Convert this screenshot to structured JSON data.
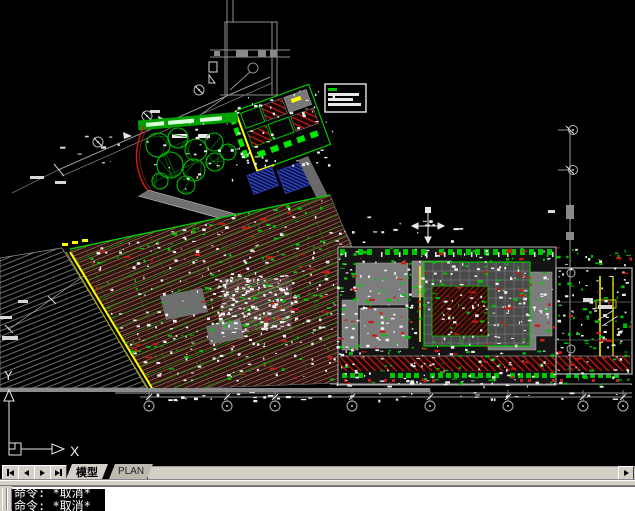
{
  "colors": {
    "canvas_bg": "#000000",
    "chrome_bg": "#d4d0c8",
    "cad_gray": "#8c8c8c",
    "light_gray": "#b4b4b4",
    "white": "#f0f0f0",
    "green": "#00c800",
    "bright_green": "#00e600",
    "dark_green": "#007800",
    "red": "#c81e14",
    "dark_red": "#8f1e14",
    "brown_hatch": "#9a5448",
    "yellow": "#ffff00",
    "blue_hatch_line": "#3c55d2",
    "blue_hatch_bg": "#0a1250"
  },
  "tabs": {
    "nav": [
      {
        "name": "first-tab-button"
      },
      {
        "name": "prev-tab-button"
      },
      {
        "name": "next-tab-button"
      },
      {
        "name": "last-tab-button"
      }
    ],
    "items": [
      {
        "label": "模型",
        "active": true
      },
      {
        "label": "PLAN",
        "active": false
      }
    ]
  },
  "command": {
    "lines": [
      "命令: *取消*",
      "命令: *取消*"
    ]
  },
  "ucs": {
    "x_label": "X",
    "y_label": "Y"
  }
}
